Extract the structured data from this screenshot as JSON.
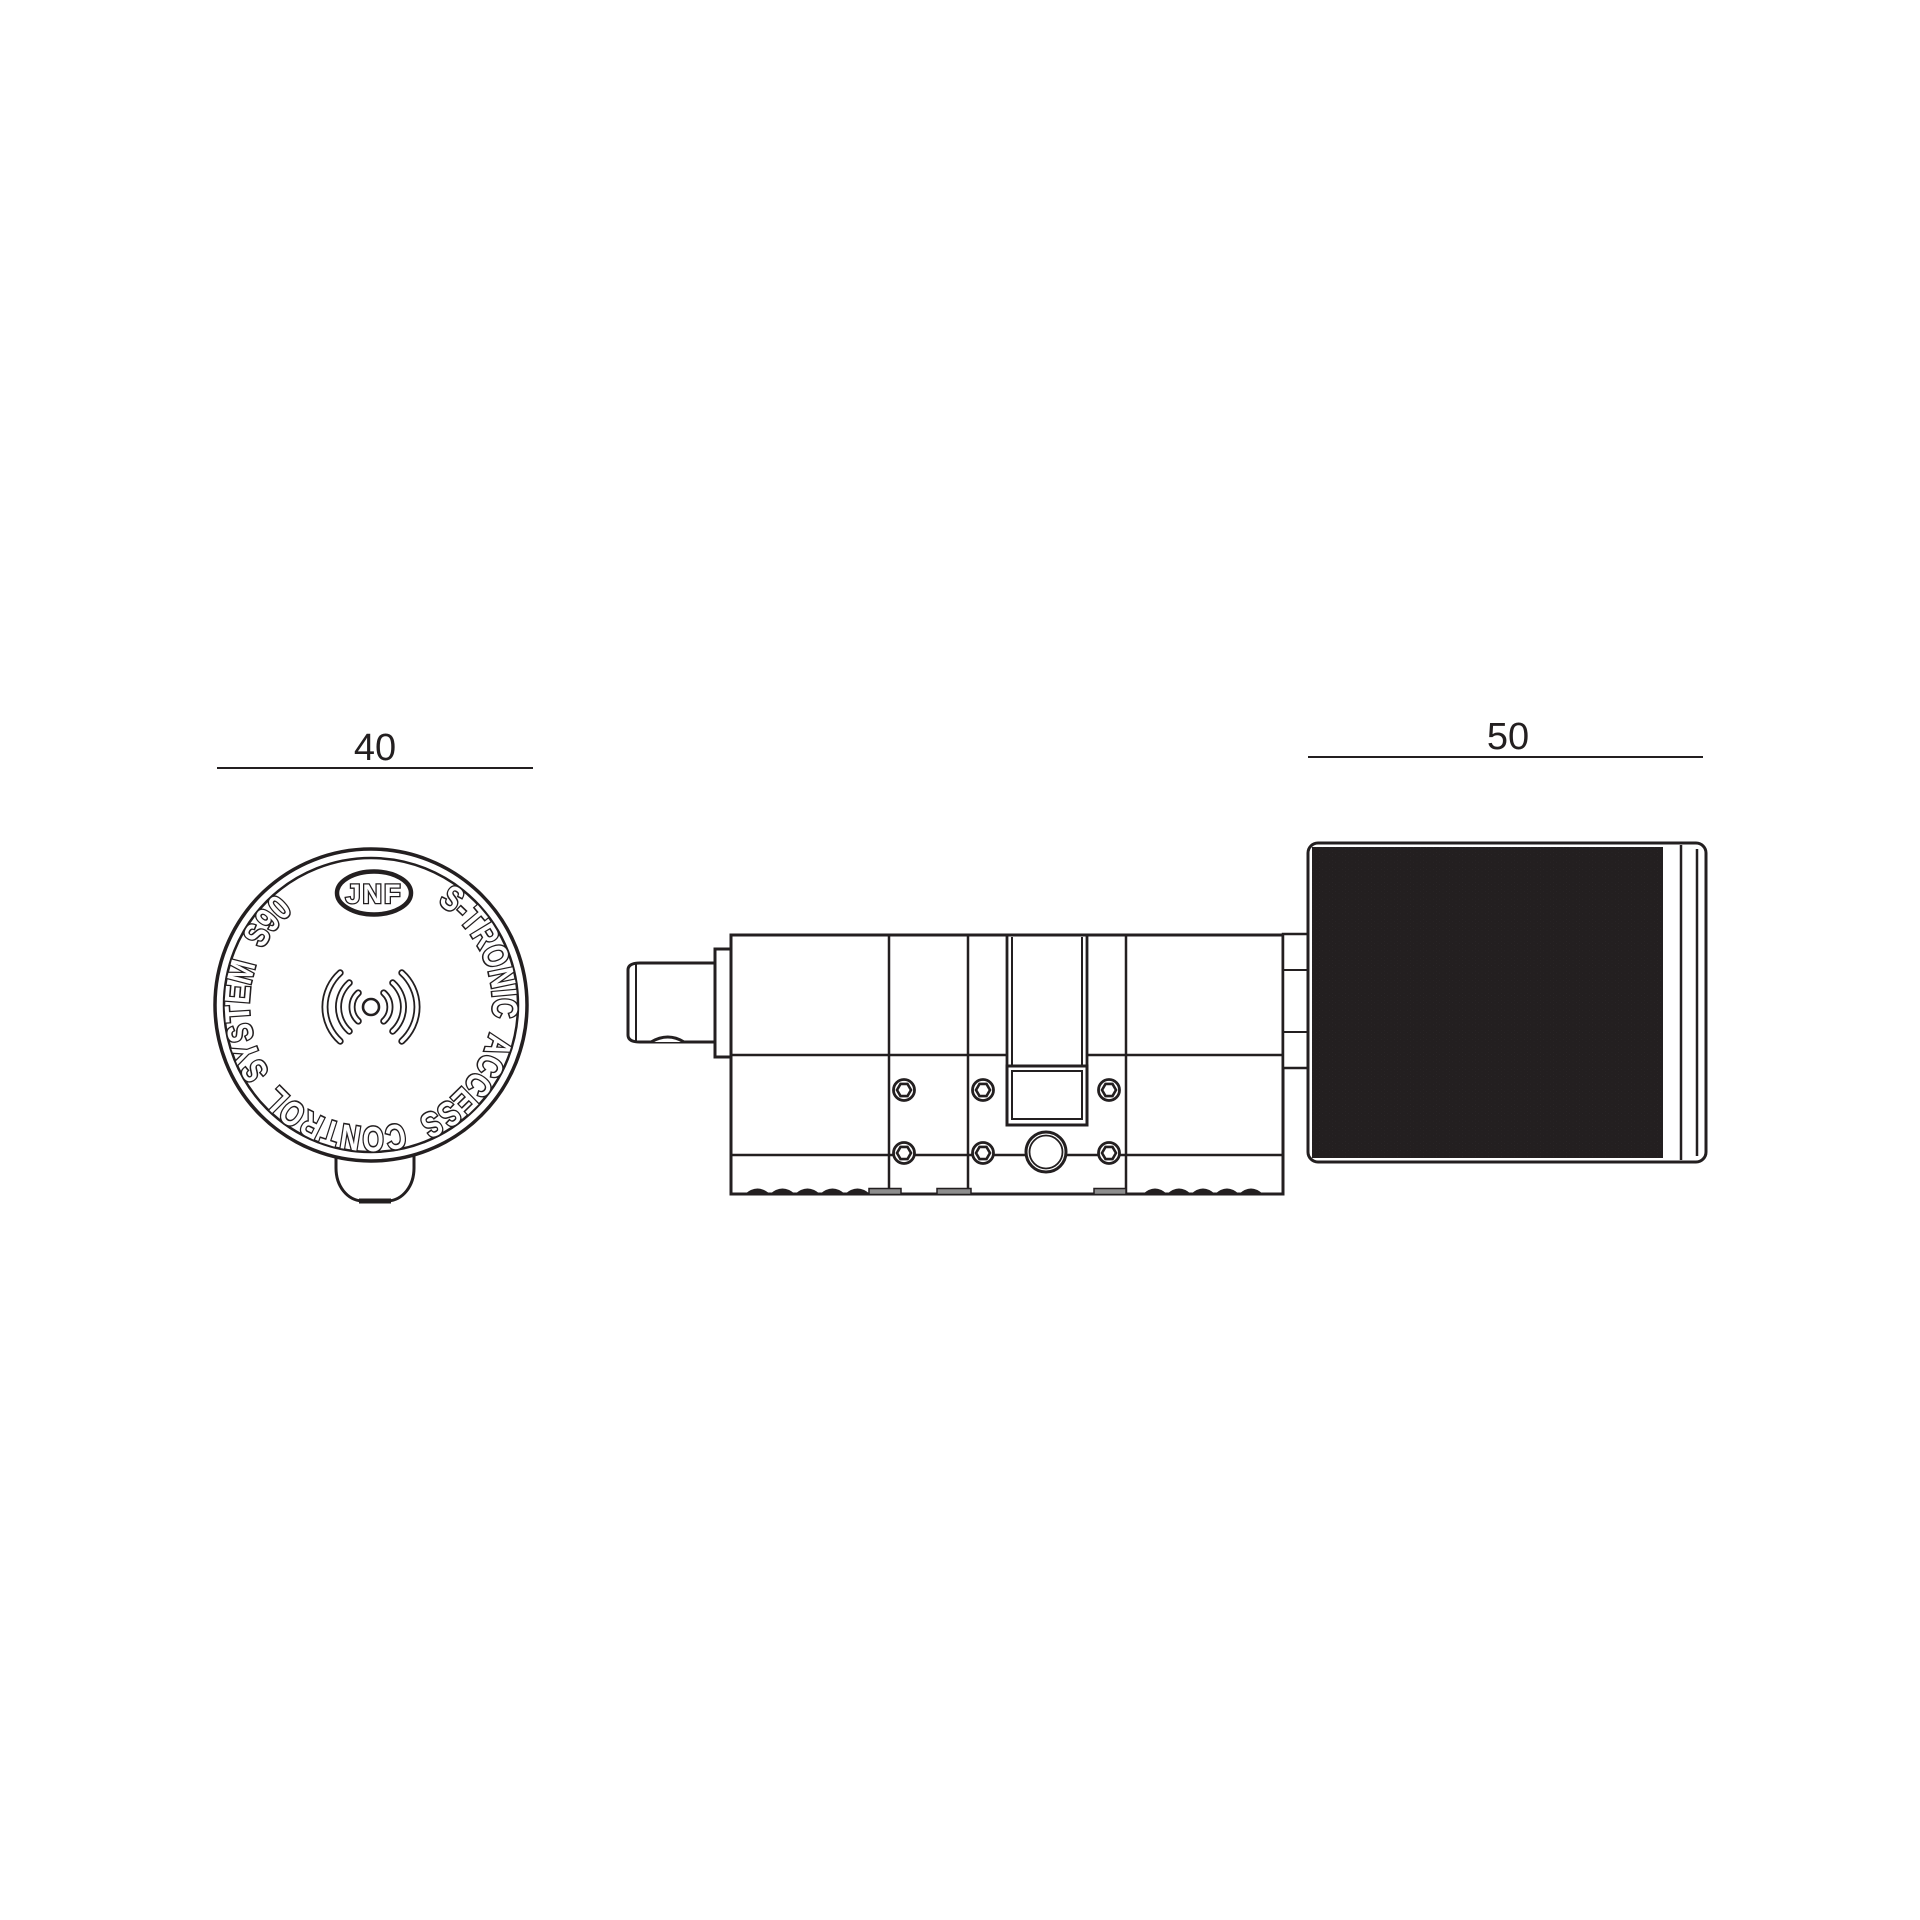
{
  "colors": {
    "ink": "#231f20",
    "paper": "#ffffff",
    "recess_fill": "#8d8d8d"
  },
  "dimensions": {
    "face_diameter": "40",
    "knob_length": "50"
  },
  "face_view": {
    "ring_text": "S-TRONIC ACCESS CONTROL SYSTEM S90",
    "logo_text": "JNF",
    "center_icon": "contactless-signal-icon"
  }
}
